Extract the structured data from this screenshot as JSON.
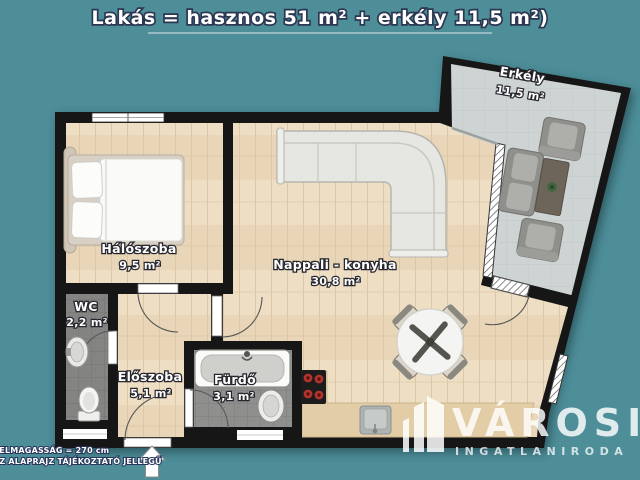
{
  "title": {
    "text": "Lakás = hasznos 51 m² + erkély 11,5 m²)"
  },
  "rooms": {
    "haloszoba": {
      "name": "Hálószoba",
      "area": "9,5 m²"
    },
    "wc": {
      "name": "WC",
      "area": "2,2 m²"
    },
    "eloszoba": {
      "name": "Előszoba",
      "area": "5,1 m²"
    },
    "furdo": {
      "name": "Fürdő",
      "area": "3,1 m²"
    },
    "nappali": {
      "name": "Nappali - konyha",
      "area": "30,8 m²"
    },
    "erkely": {
      "name": "Erkély",
      "area": "11,5 m²"
    }
  },
  "footnote": {
    "line1": "BELMAGASSÁG = 270 cm",
    "line2": "AZ ALAPRAJZ TÁJÉKOZTATÓ JELLEGŰ"
  },
  "logo": {
    "name": "VÁROSI",
    "subtitle": "INGATLANIRODA"
  },
  "icons": {
    "entrance": "up-arrow-icon"
  },
  "colors": {
    "background": "#4d8e99",
    "wall": "#161616",
    "wood_floor": "#eedec4",
    "tile_floor": "#8f8f8d",
    "balcony_floor": "#ced4d3",
    "counter": "#e3cda6",
    "burner_red": "#b3342c",
    "label_fill": "#ffffff",
    "label_outline": "#26262e",
    "title_outline": "#2c3752"
  }
}
